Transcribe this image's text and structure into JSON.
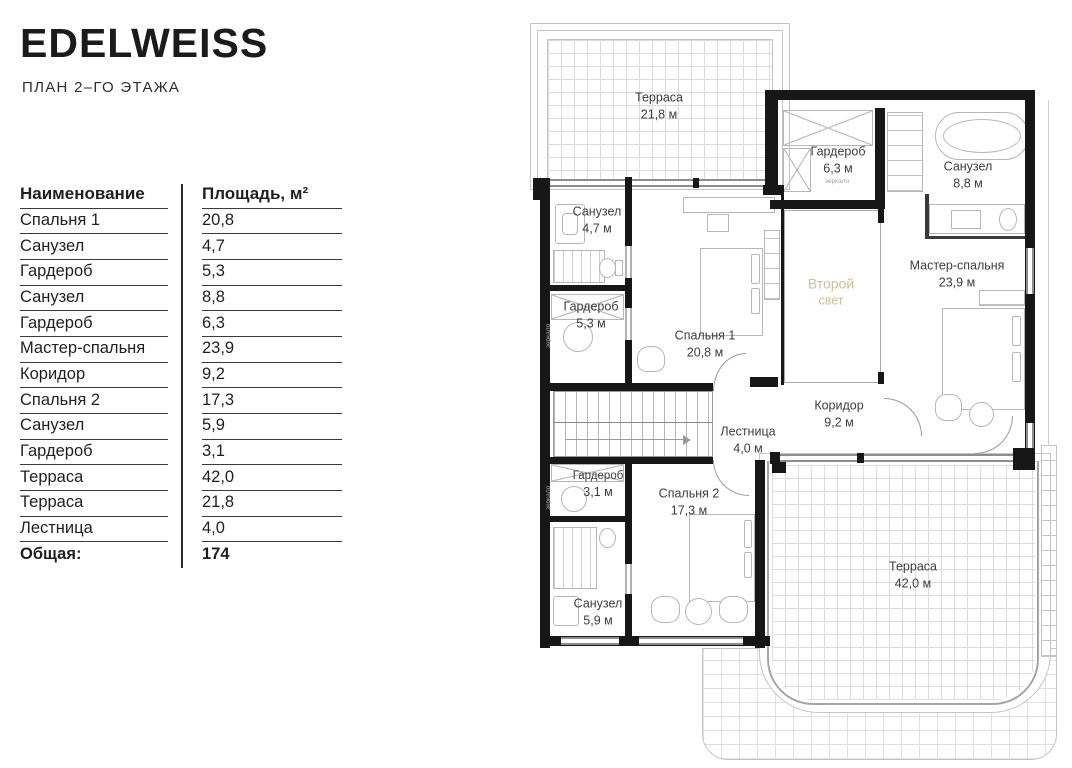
{
  "header": {
    "title": "EDELWEISS",
    "subtitle": "ПЛАН 2–ГО ЭТАЖА"
  },
  "table": {
    "col_name": "Наименование",
    "col_area": "Площадь, м²",
    "rows": [
      {
        "name": "Спальня 1",
        "area": "20,8"
      },
      {
        "name": "Санузел",
        "area": "4,7"
      },
      {
        "name": "Гардероб",
        "area": "5,3"
      },
      {
        "name": "Санузел",
        "area": "8,8"
      },
      {
        "name": "Гардероб",
        "area": "6,3"
      },
      {
        "name": "Мастер-спальня",
        "area": "23,9"
      },
      {
        "name": "Коридор",
        "area": "9,2"
      },
      {
        "name": "Спальня 2",
        "area": "17,3"
      },
      {
        "name": "Санузел",
        "area": "5,9"
      },
      {
        "name": "Гардероб",
        "area": "3,1"
      },
      {
        "name": "Терраса",
        "area": "42,0"
      },
      {
        "name": "Терраса",
        "area": "21,8"
      },
      {
        "name": "Лестница",
        "area": "4,0"
      }
    ],
    "total_label": "Общая:",
    "total_value": "174"
  },
  "plan": {
    "rooms": [
      {
        "id": "terrace-top",
        "name": "Терраса",
        "area": "21,8 м"
      },
      {
        "id": "wardrobe-6-3",
        "name": "Гардероб",
        "area": "6,3 м"
      },
      {
        "id": "bathroom-8-8",
        "name": "Санузел",
        "area": "8,8 м"
      },
      {
        "id": "bathroom-4-7",
        "name": "Санузел",
        "area": "4,7 м"
      },
      {
        "id": "wardrobe-5-3",
        "name": "Гардероб",
        "area": "5,3 м"
      },
      {
        "id": "bedroom-1",
        "name": "Спальня 1",
        "area": "20,8 м"
      },
      {
        "id": "second-light",
        "name": "Второй",
        "area": "свет"
      },
      {
        "id": "master",
        "name": "Мастер-спальня",
        "area": "23,9 м"
      },
      {
        "id": "corridor",
        "name": "Коридор",
        "area": "9,2 м"
      },
      {
        "id": "stairs",
        "name": "Лестница",
        "area": "4,0 м"
      },
      {
        "id": "wardrobe-3-1",
        "name": "Гардероб",
        "area": "3,1 м"
      },
      {
        "id": "bedroom-2",
        "name": "Спальня 2",
        "area": "17,3 м"
      },
      {
        "id": "bathroom-5-9",
        "name": "Санузел",
        "area": "5,9 м"
      },
      {
        "id": "terrace-bottom",
        "name": "Терраса",
        "area": "42,0 м"
      }
    ],
    "mirror_label": "зеркало",
    "colors": {
      "wall": "#171717",
      "second_light_text": "#d5bd93",
      "thin_line": "#c4c4c4"
    }
  }
}
